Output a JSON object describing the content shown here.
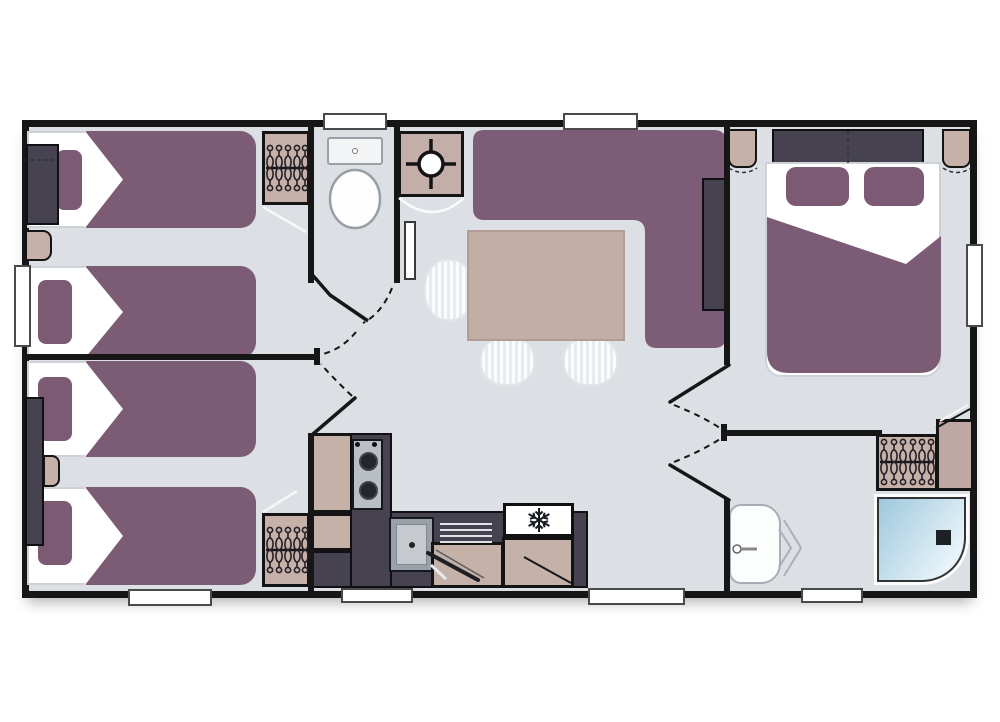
{
  "diagram": {
    "kind": "mobile-home-floor-plan-top-view",
    "has_text_labels": false,
    "palette": {
      "wall": "#161616",
      "floor": "#dcdfe3",
      "exterior": "#ffffff",
      "upholstery_purple": "#7c5b75",
      "dark_furniture": "#474250",
      "wood_beige": "#c6b1a9",
      "table_beige": "#c3aea5",
      "steel_grey": "#b9bfc5",
      "shower_blue": "#9fc8dd",
      "fixture_white": "#fdfdfd"
    },
    "rooms": [
      {
        "id": "bedroom-twin-top-left",
        "items": [
          "single-bed",
          "single-bed",
          "purple-pillows",
          "duvets-with-fold",
          "headboard-cabinet",
          "nightstand",
          "wardrobe-with-hangers",
          "left-window"
        ]
      },
      {
        "id": "bedroom-twin-bottom-left",
        "items": [
          "single-bed",
          "single-bed",
          "purple-pillows",
          "duvets-with-fold",
          "tall-side-cabinet",
          "nightstand",
          "wardrobe-with-hangers",
          "bottom-window"
        ]
      },
      {
        "id": "wc",
        "items": [
          "toilet-with-cistern",
          "top-window",
          "outward-swing-door"
        ]
      },
      {
        "id": "technical-cupboard",
        "items": [
          "water-heater-crosshair-symbol"
        ]
      },
      {
        "id": "living-dining",
        "items": [
          "l-shaped-corner-sofa",
          "sideboard-behind-sofa",
          "dining-table",
          "wicker-chair",
          "wicker-chair",
          "wicker-chair",
          "top-window",
          "wall-panel"
        ]
      },
      {
        "id": "kitchen",
        "items": [
          "hob-two-burners",
          "sink-with-drainer",
          "pan",
          "fridge-with-snowflake",
          "base-cabinets",
          "bottom-window"
        ]
      },
      {
        "id": "bedroom-master-right",
        "items": [
          "double-bed",
          "headboard",
          "two-purple-pillows",
          "duvet-with-folded-corner",
          "nightstand",
          "nightstand",
          "right-window"
        ]
      },
      {
        "id": "shower-room-bottom-right",
        "items": [
          "shower-tray-with-drain",
          "washbasin-with-tap",
          "folding-door-chevrons",
          "wardrobe-with-hangers",
          "cabinet",
          "bottom-window"
        ]
      }
    ],
    "doors": [
      "wc-door",
      "bedroom-bottom-left-door",
      "master-bedroom-door",
      "shower-room-door"
    ],
    "inventory": {
      "single_beds": 4,
      "double_beds": 1,
      "dining_chairs": 3,
      "wardrobes_with_hangers": 3,
      "windows": 8,
      "hob_burners": 2,
      "toilets": 1,
      "showers": 1,
      "washbasins": 1,
      "fridges": 1,
      "water_heaters": 1
    }
  }
}
